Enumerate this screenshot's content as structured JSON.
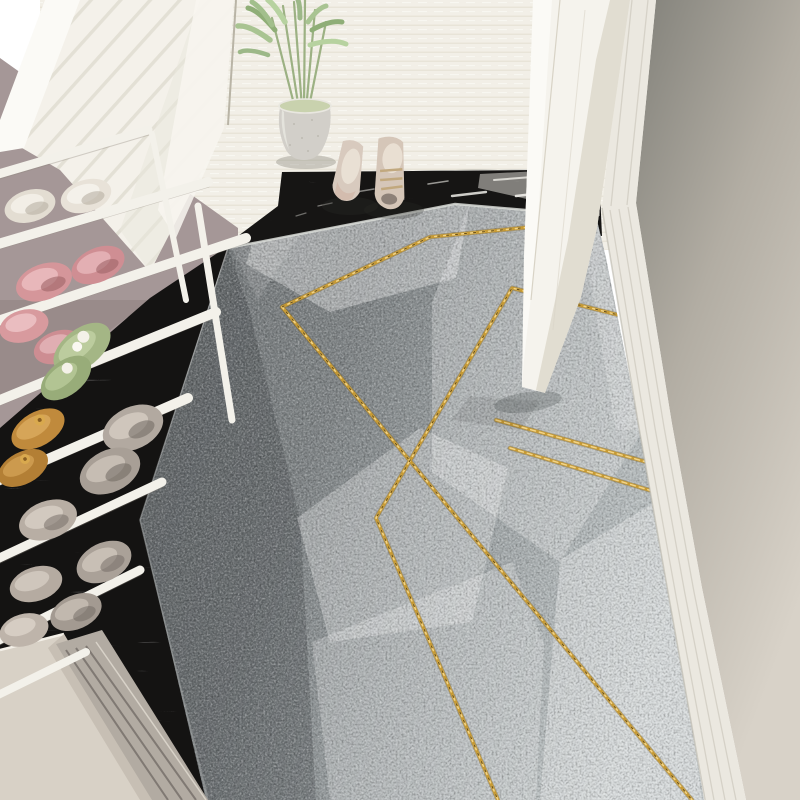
{
  "scene": {
    "description": "Top-down entryway photo: geometric gray runner rug with gold zigzag lines, white wire shoe rack with colorful shoes, white slatted cabinet panel, potted green plant, pair of beige loafers, black marble threshold, open white door and beige wall with baseboard",
    "objects": [
      "entry-plank-floor",
      "left-mauve-wall",
      "white-cabinet-panel",
      "shoe-rack",
      "rack-shoes",
      "black-marble-threshold",
      "geometric-runner-rug",
      "gold-accent-lines",
      "storage-bench",
      "potted-plant",
      "beige-loafers",
      "open-white-door",
      "right-wall",
      "baseboard-molding"
    ]
  },
  "palette": {
    "plank": "#f2efe7",
    "plank_line": "#e4e1d5",
    "panel": "#f4f1ea",
    "wall_left": "#a59797",
    "marble": "#161514",
    "carpet_dark": "#6e7274",
    "carpet_mid1": "#7e8385",
    "carpet_mid2": "#9aa0a2",
    "carpet_light": "#c6cccd",
    "gold": "#c79a32",
    "gold_bright": "#f2d488",
    "slab": "#f5f3ed",
    "wall_right_dark": "#82817a",
    "wall_right_mid": "#b2ada3",
    "wall_right_light": "#d8d2c8",
    "molding": "#ebe8e0",
    "bench": "#d8d1c6",
    "rail": "#f3f1ea",
    "pot": "#d2cfc9",
    "plant_green": "#9cb183",
    "loafer": "#d8cabe",
    "shoe_pink": "#d5969a",
    "shoe_green": "#a4b685",
    "shoe_tan": "#c08a3c",
    "shoe_gray": "#b0a79e",
    "shoe_cream": "#e3ddd2"
  }
}
